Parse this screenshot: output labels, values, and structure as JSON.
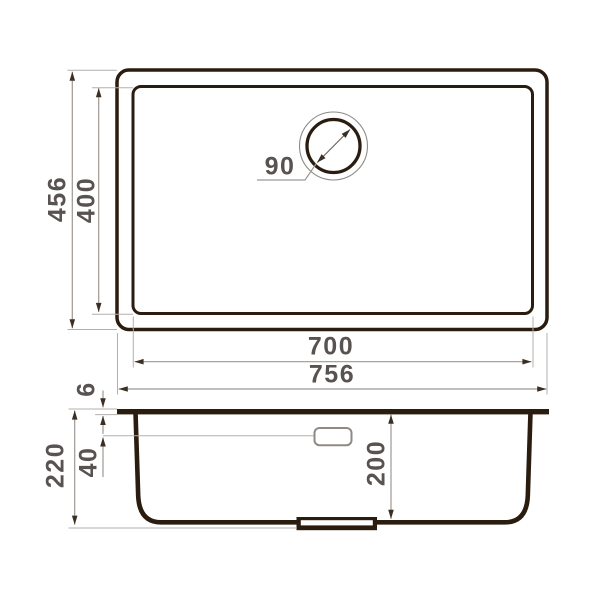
{
  "drawing": {
    "type": "sink-dimension-diagram",
    "top_view": {
      "outer_height": "456",
      "inner_height": "400",
      "inner_width": "700",
      "outer_width": "756",
      "drain_diameter": "90"
    },
    "side_view": {
      "rim_thickness": "6",
      "overall_depth": "220",
      "overflow_offset": "40",
      "bowl_depth": "200"
    },
    "colors": {
      "outline": "#2b1c10",
      "dim_line": "#9e9893",
      "extension_line": "#b4afab",
      "arrowhead": "#3b2f24",
      "label_text": "#585250",
      "background": "#ffffff"
    }
  }
}
